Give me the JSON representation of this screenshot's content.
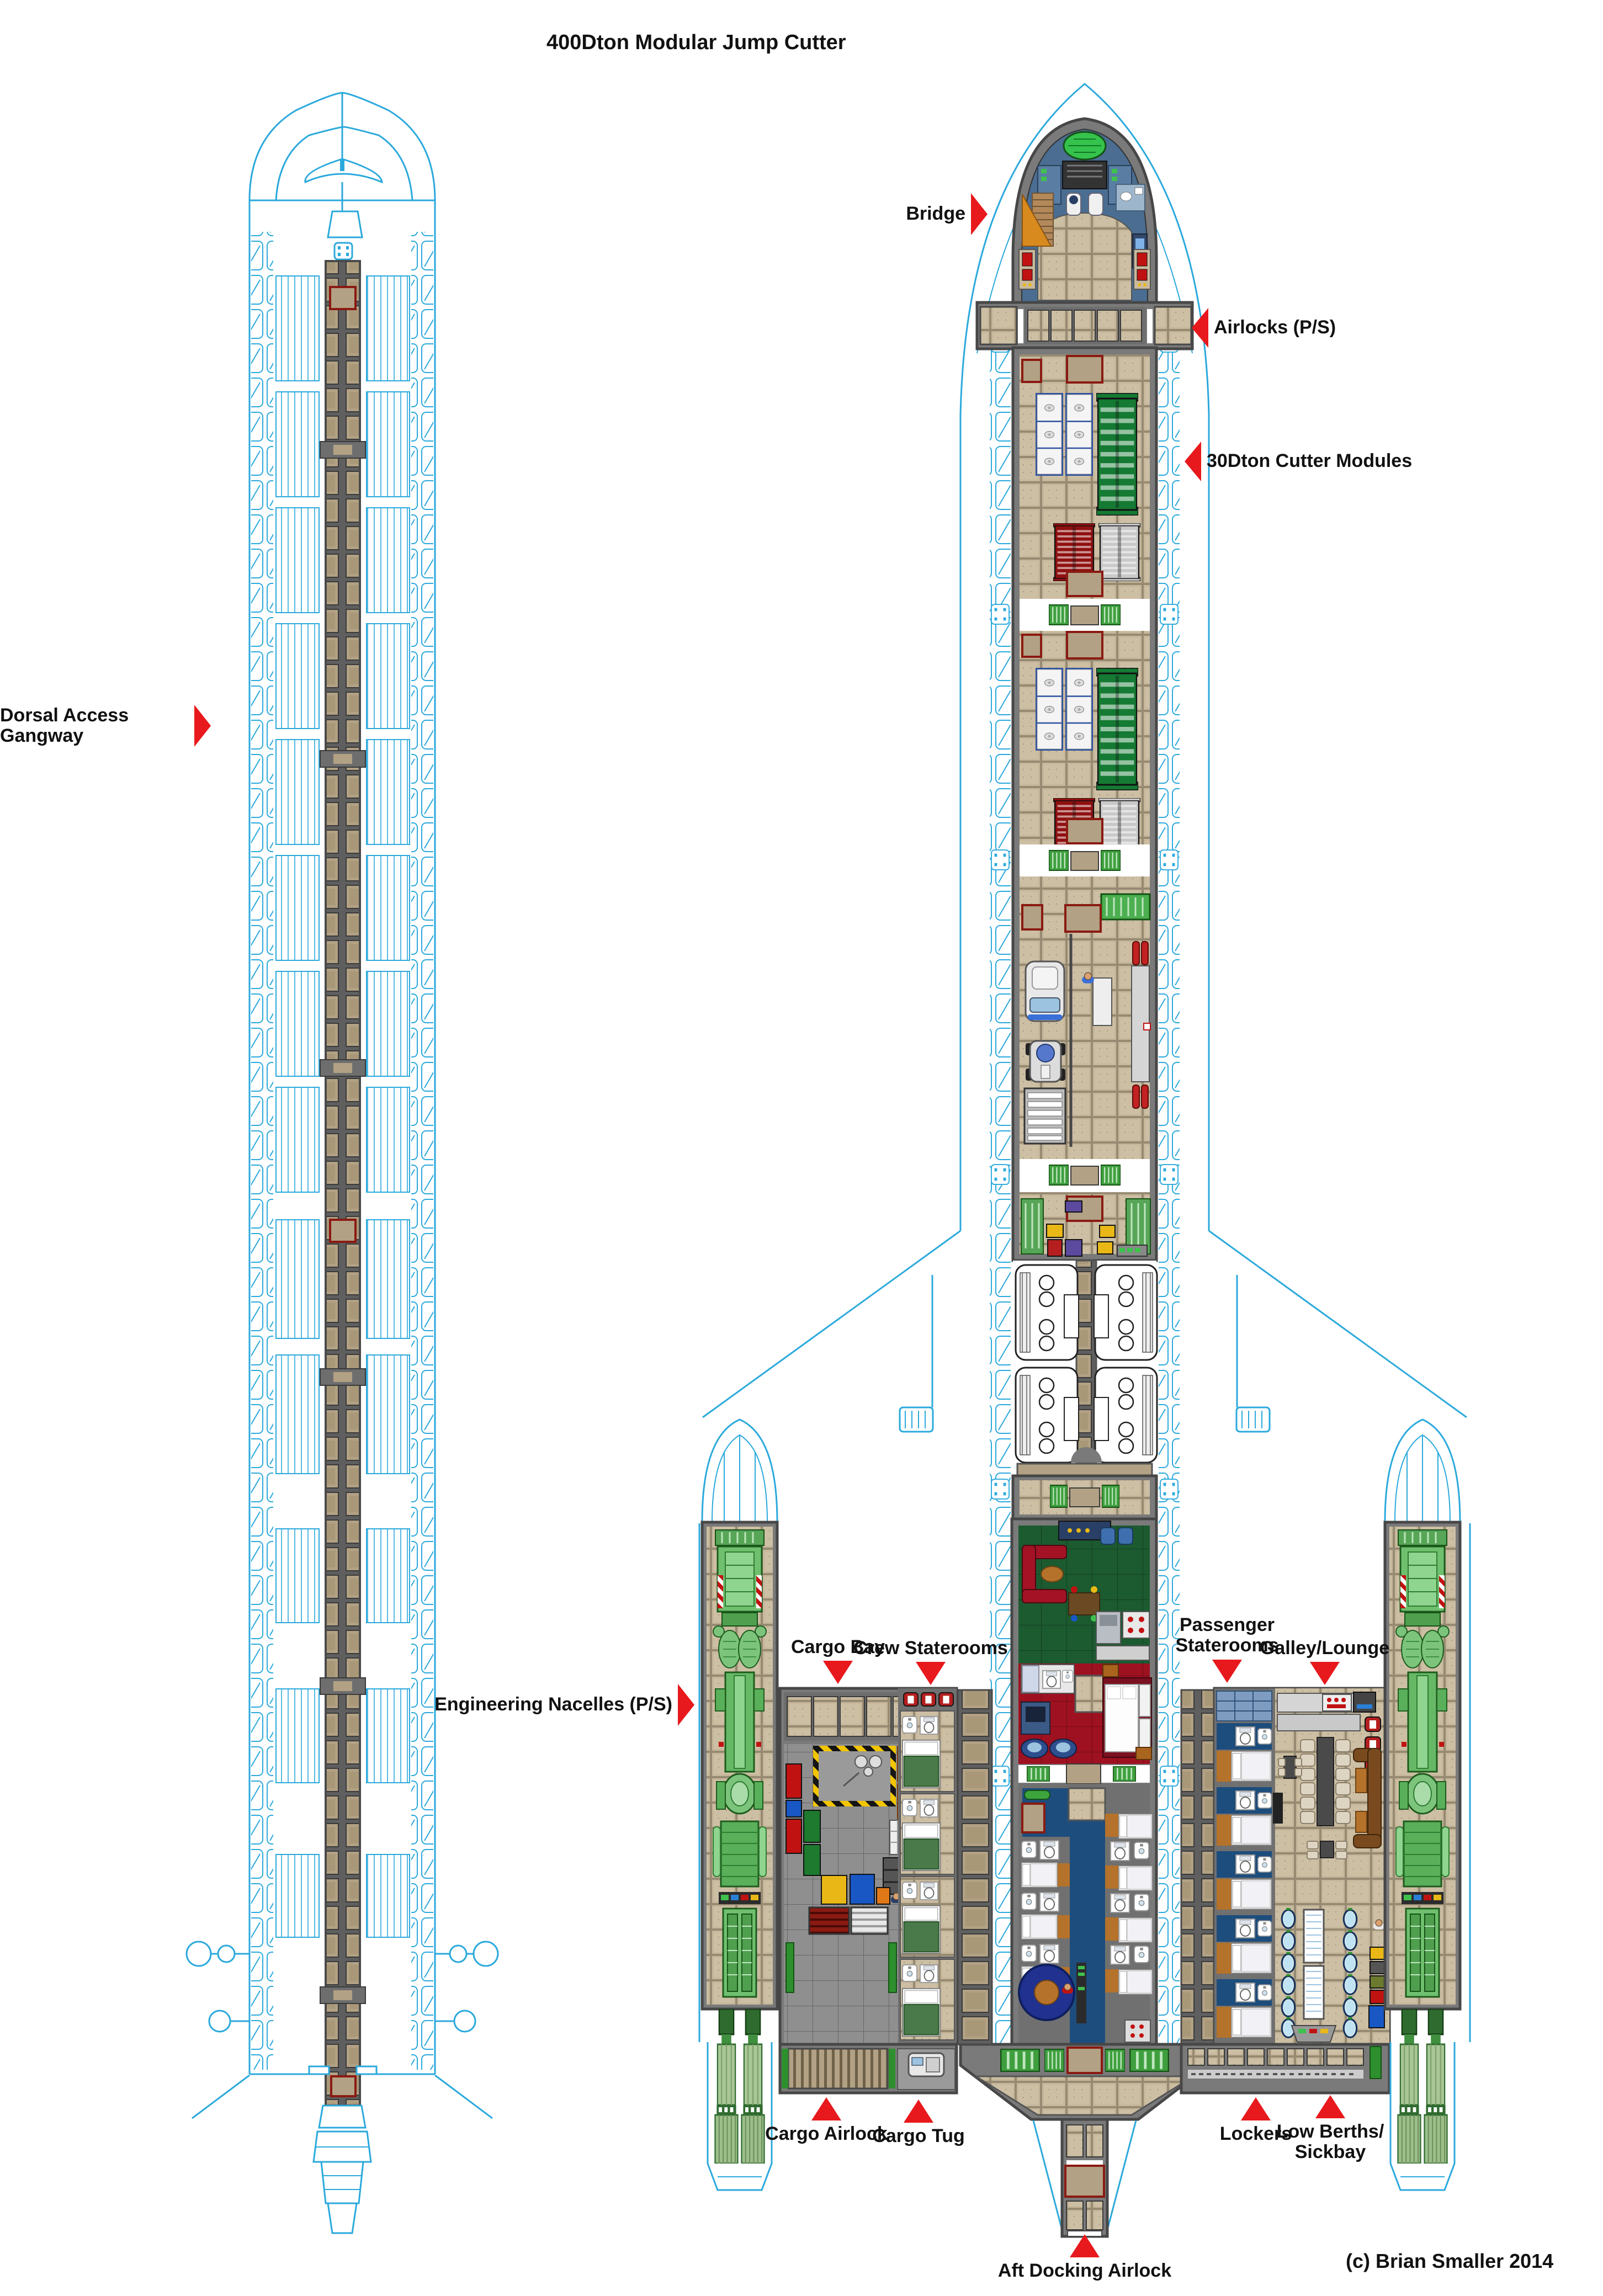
{
  "title": "400Dton Modular Jump Cutter",
  "copyright": "(c) Brian Smaller 2014",
  "diagram": {
    "type": "starship-deck-plan",
    "views": [
      "dorsal-access-gangway-view",
      "main-deck-plan-view"
    ]
  },
  "labels": [
    {
      "id": "bridge",
      "text": "Bridge",
      "arrow": "right"
    },
    {
      "id": "airlocks",
      "text": "Airlocks (P/S)",
      "arrow": "left"
    },
    {
      "id": "cutter-modules",
      "text": "30Dton Cutter Modules",
      "arrow": "left"
    },
    {
      "id": "dorsal-gangway",
      "text": "Dorsal Access Gangway",
      "arrow": "right"
    },
    {
      "id": "engineering-nacelles",
      "text": "Engineering Nacelles (P/S)",
      "arrow": "right"
    },
    {
      "id": "cargo-bay",
      "text": "Cargo Bay",
      "arrow": "down"
    },
    {
      "id": "crew-staterooms",
      "text": "Crew Staterooms",
      "arrow": "down"
    },
    {
      "id": "passenger-staterooms",
      "text": "Passenger\nStaterooms",
      "arrow": "down"
    },
    {
      "id": "galley-lounge",
      "text": "Galley/Lounge",
      "arrow": "down"
    },
    {
      "id": "cargo-airlock",
      "text": "Cargo Airlock",
      "arrow": "up"
    },
    {
      "id": "cargo-tug",
      "text": "Cargo Tug",
      "arrow": "up"
    },
    {
      "id": "lockers",
      "text": "Lockers",
      "arrow": "up"
    },
    {
      "id": "low-berths",
      "text": "Low Berths/\nSickbay",
      "arrow": "up"
    },
    {
      "id": "aft-docking-airlock",
      "text": "Aft Docking Airlock",
      "arrow": "up"
    }
  ],
  "colors": {
    "outline_cyan": "#2ba9dc",
    "label_red": "#e8191c",
    "text_black": "#111111",
    "hull_gray": "#7a7a7a",
    "wall_dark": "#474747",
    "floor_tan": "#c6b79b",
    "floor_blue": "#1d4d7c",
    "floor_green": "#1c5a30",
    "floor_red": "#9e1120",
    "machinery_green": "#6fbf6f",
    "rack_green": "#157a33",
    "rack_red": "#8f1010",
    "rack_white": "#c9c9c9",
    "container_orange": "#e07818",
    "hazard_yellow": "#f2c500"
  }
}
